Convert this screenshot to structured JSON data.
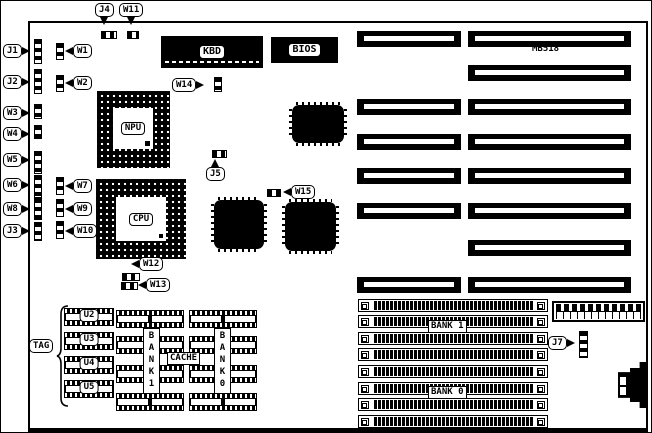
{
  "board": {
    "model": "MB518"
  },
  "callouts": {
    "j1": "J1",
    "j2": "J2",
    "j3": "J3",
    "j4": "J4",
    "j5": "J5",
    "j7": "J7",
    "w1": "W1",
    "w2": "W2",
    "w3": "W3",
    "w4": "W4",
    "w5": "W5",
    "w6": "W6",
    "w7": "W7",
    "w8": "W8",
    "w9": "W9",
    "w10": "W10",
    "w11": "W11",
    "w12": "W12",
    "w13": "W13",
    "w14": "W14",
    "w15": "W15",
    "tag": "TAG"
  },
  "chips": {
    "kbd": "KBD",
    "bios": "BIOS",
    "npu": "NPU",
    "cpu": "CPU",
    "u2": "U2",
    "u3": "U3",
    "u4": "U4",
    "u5": "U5",
    "cache": "CACHE",
    "cache_bank1": "BANK1",
    "cache_bank0": "BANK0"
  },
  "memory": {
    "bank1": "BANK 1",
    "bank0": "BANK 0"
  }
}
